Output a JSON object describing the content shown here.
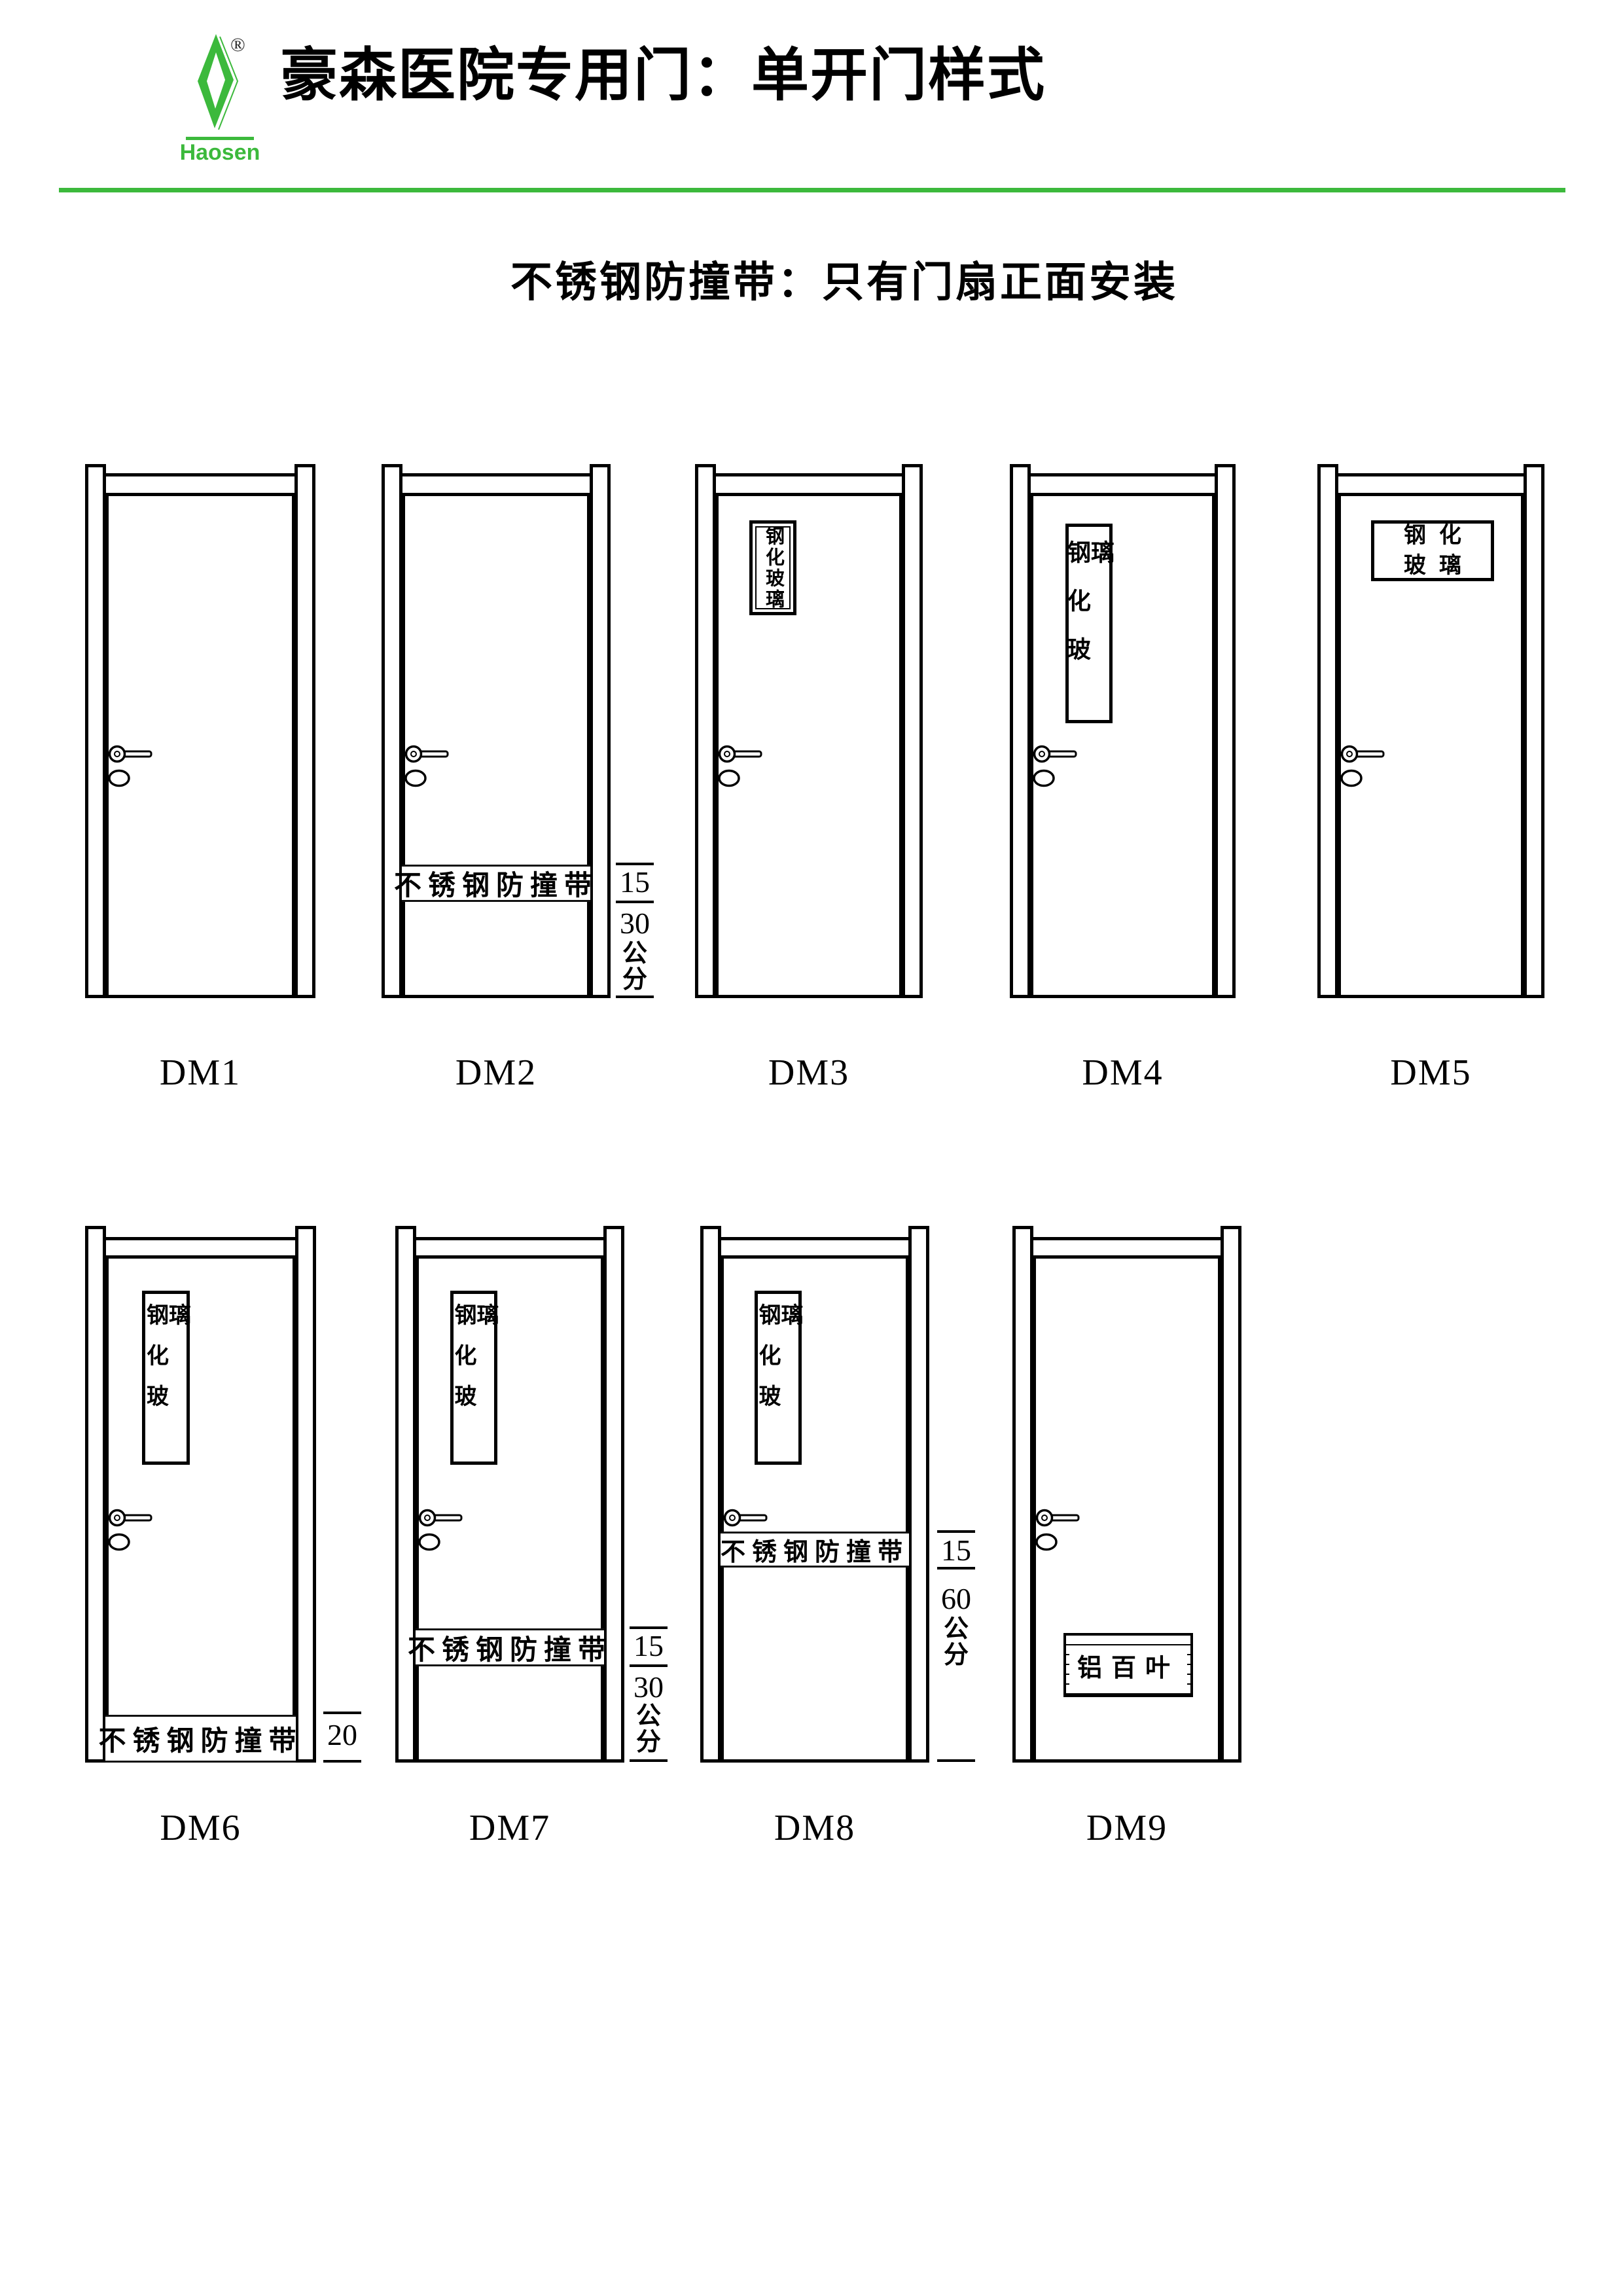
{
  "page": {
    "background": "#ffffff",
    "accent_green": "#3cb93c",
    "line_color": "#000000"
  },
  "header": {
    "brand": "Haosen",
    "registered_mark": "®",
    "title": "豪森医院专用门：单开门样式",
    "subtitle": "不锈钢防撞带：只有门扇正面安装"
  },
  "doors": [
    {
      "label": "DM1"
    },
    {
      "label": "DM2",
      "strip": "不锈钢防撞带",
      "dims": [
        "15",
        "30",
        "公",
        "分"
      ]
    },
    {
      "label": "DM3",
      "glass": "钢化玻璃"
    },
    {
      "label": "DM4",
      "glass": "钢化玻璃"
    },
    {
      "label": "DM5",
      "glass_lines": [
        "钢化",
        "玻璃"
      ]
    },
    {
      "label": "DM6",
      "glass": "钢化玻璃",
      "strip": "不锈钢防撞带",
      "dims": [
        "20"
      ]
    },
    {
      "label": "DM7",
      "glass": "钢化玻璃",
      "strip": "不锈钢防撞带",
      "dims": [
        "15",
        "30",
        "公",
        "分"
      ]
    },
    {
      "label": "DM8",
      "glass": "钢化玻璃",
      "strip": "不锈钢防撞带",
      "dims": [
        "15",
        "60",
        "公",
        "分"
      ]
    },
    {
      "label": "DM9",
      "louver": "铝百叶"
    }
  ]
}
